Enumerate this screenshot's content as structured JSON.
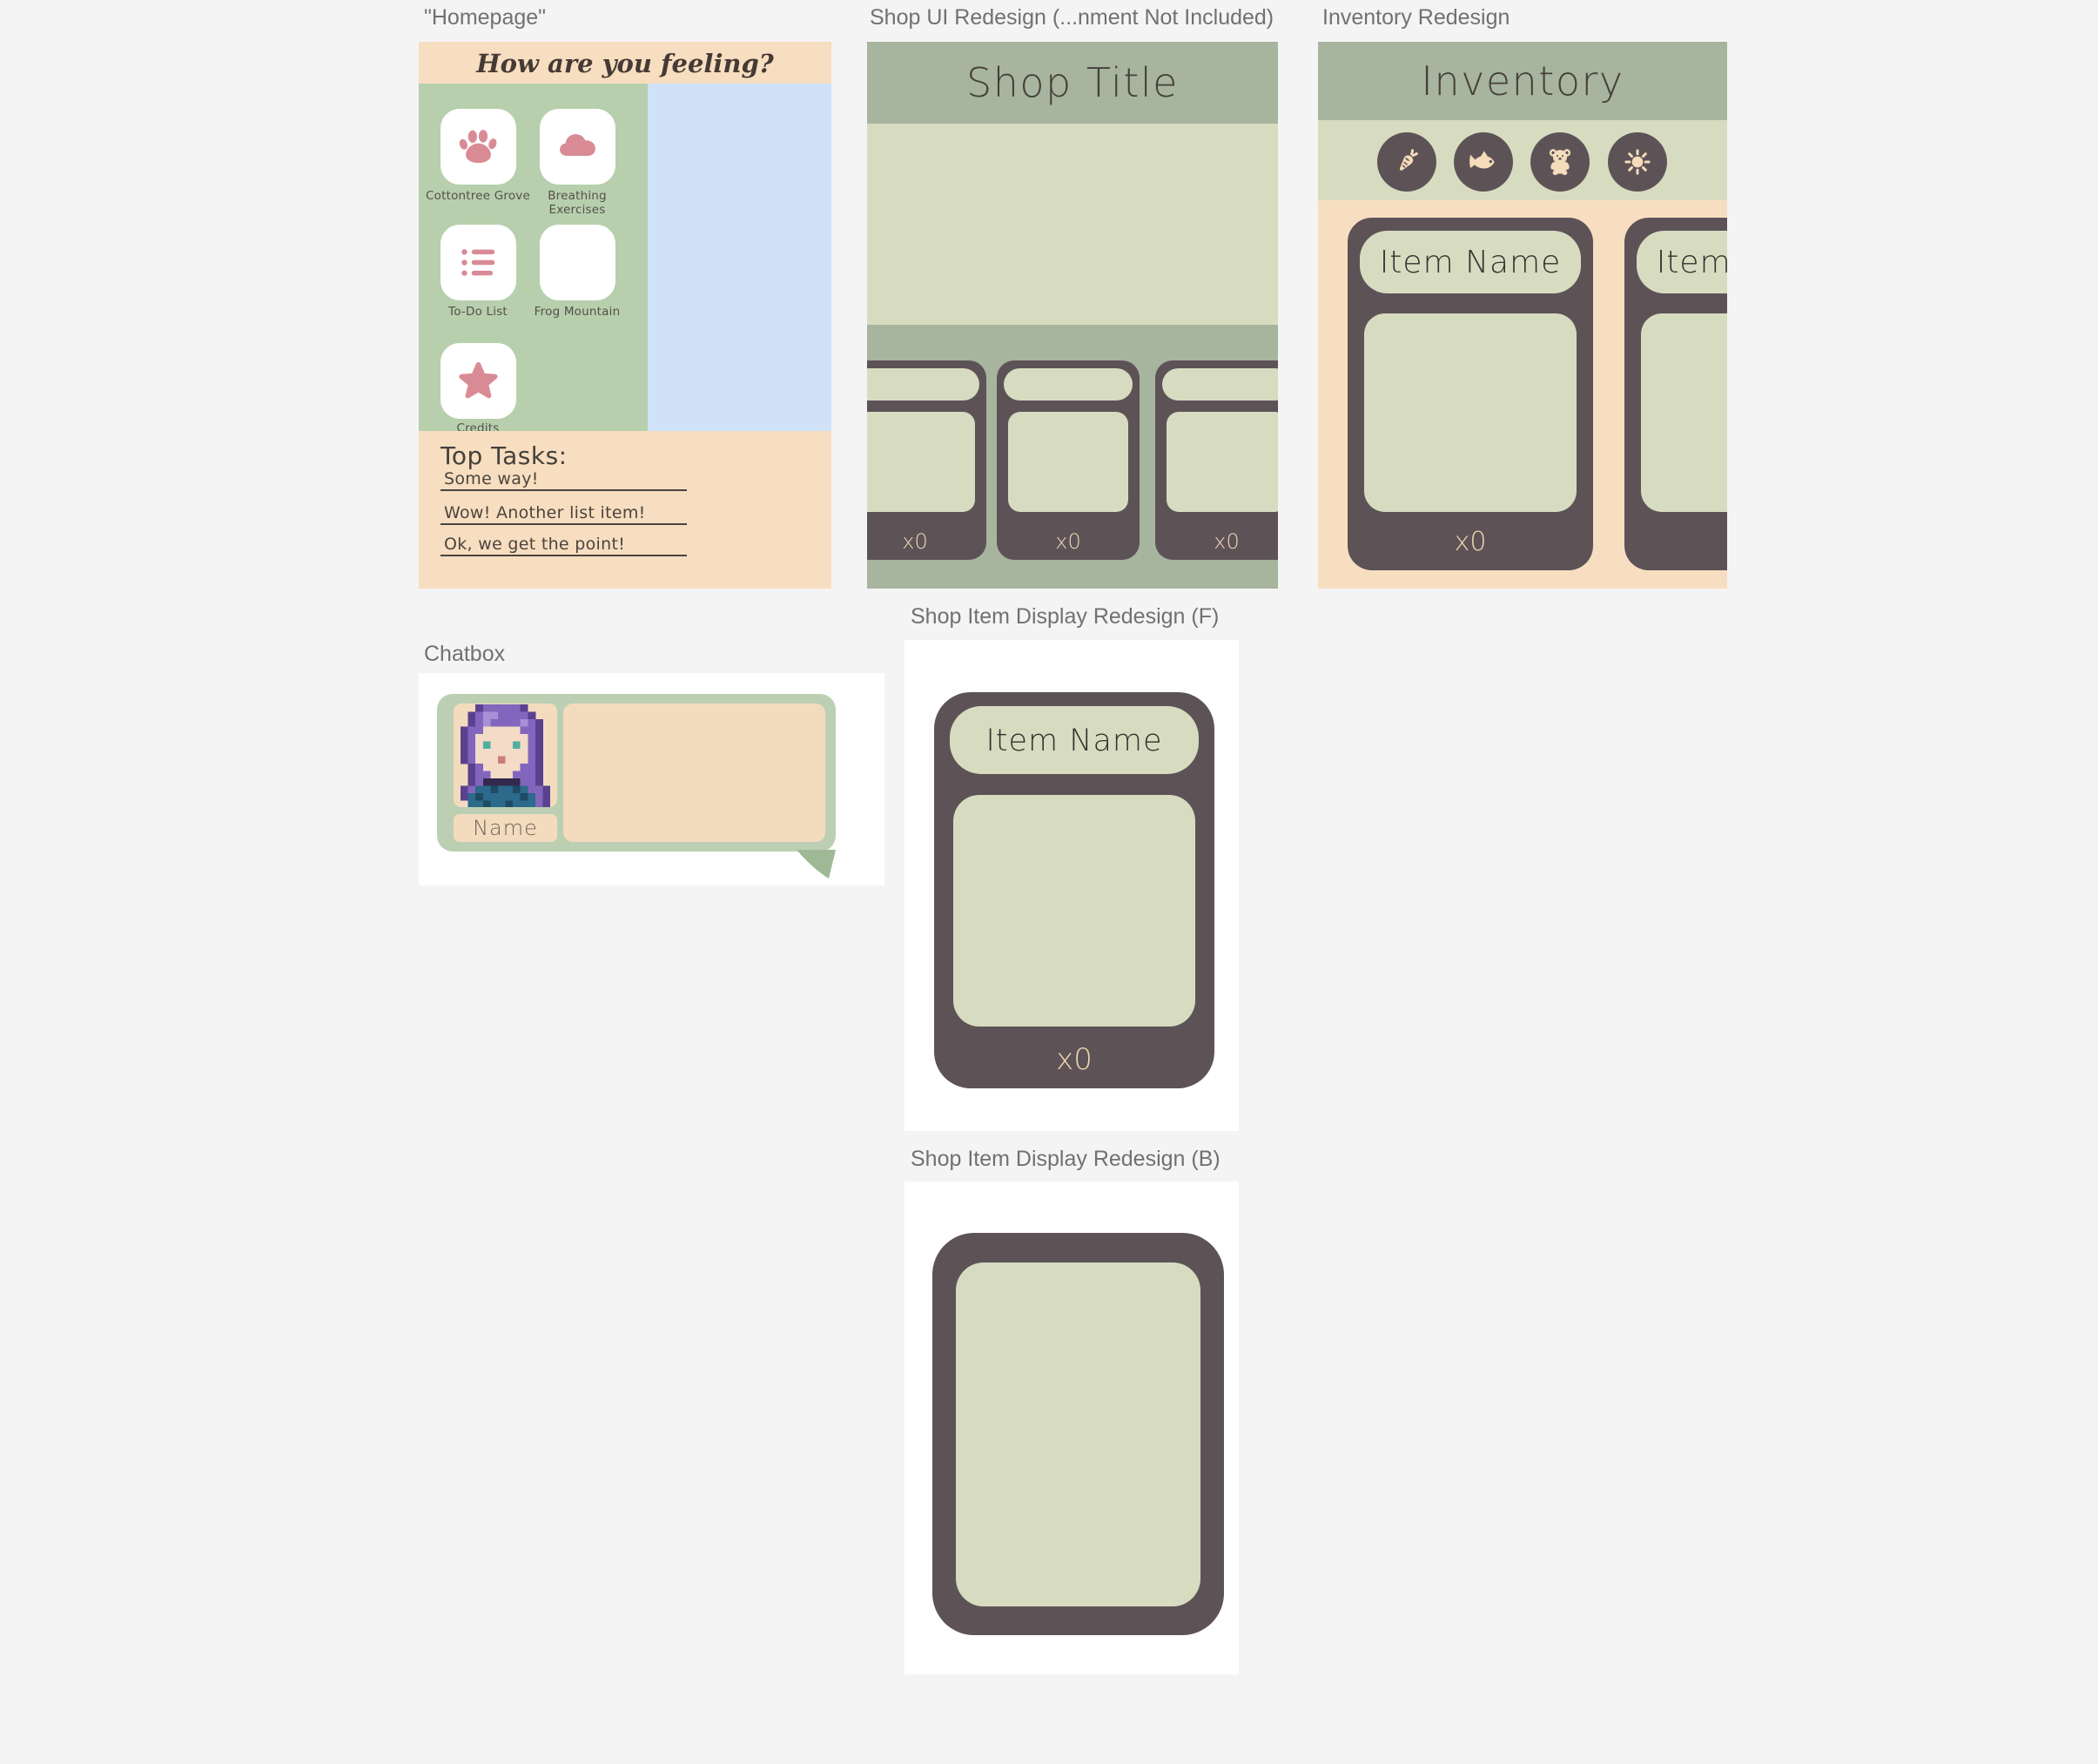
{
  "colors": {
    "canvas_bg": "#f4f4f5",
    "frame_label": "#717171",
    "peach": "#f7dec0",
    "homepage_green": "#b7cfad",
    "blue_panel": "#cfe2f8",
    "tile_white": "#ffffff",
    "icon_pink": "#d98b95",
    "sage": "#a7b49e",
    "pale_olive": "#d7dcc1",
    "card_dark": "#5d5357",
    "qty_peach": "#eed6b2",
    "text_dark": "#45403a",
    "chat_green": "#bccfb3",
    "chat_tail_green": "#9fb996",
    "chat_peach": "#f3dcbd",
    "underline": "#4a4440"
  },
  "homepage": {
    "label": "\"Homepage\"",
    "header_text": "How are you feeling?",
    "tiles": [
      {
        "label": "Cottontree Grove",
        "icon": "paw-icon"
      },
      {
        "label": "Breathing Exercises",
        "icon": "cloud-icon"
      },
      {
        "label": "To-Do List",
        "icon": "list-icon"
      },
      {
        "label": "Frog Mountain",
        "icon": "none"
      },
      {
        "label": "Credits",
        "icon": "star-icon"
      }
    ],
    "tasks": {
      "heading": "Top Tasks:",
      "items": [
        "Some way!",
        "Wow! Another list item!",
        "Ok, we get the point!"
      ]
    }
  },
  "shop": {
    "label": "Shop UI Redesign (...nment Not Included)",
    "title": "Shop Title",
    "cards": [
      {
        "qty": "x0"
      },
      {
        "qty": "x0"
      },
      {
        "qty": "x0"
      }
    ]
  },
  "inventory": {
    "label": "Inventory Redesign",
    "title": "Inventory",
    "categories": [
      {
        "icon": "carrot-icon"
      },
      {
        "icon": "fish-icon"
      },
      {
        "icon": "teddy-bear-icon"
      },
      {
        "icon": "sun-icon"
      }
    ],
    "cards": [
      {
        "name": "Item Name",
        "qty": "x0"
      },
      {
        "name": "Item Name",
        "qty": "x0"
      }
    ]
  },
  "chatbox": {
    "label": "Chatbox",
    "name_label": "Name",
    "avatar": {
      "palette": {
        "D": "#5a4190",
        "H": "#8266bd",
        "L": "#a88fd8",
        "S": "#f3dbc8",
        "E": "#4fae9f",
        "M": "#c97f74",
        "C": "#33294e",
        "T": "#2b6a8a",
        "K": "#1d4b63"
      },
      "rows": [
        "..DHHHHHD...",
        ".DHLLHHHHD..",
        ".DHLHHHHLHD.",
        "DHHSSSSSHHD.",
        "DHSSSSSSSHD.",
        "DHSESSSESHD.",
        "DHSSSSSSSHD.",
        "DHSSSMSSSHD.",
        ".DHSSSSSHHD.",
        ".DHHSSSHHHD.",
        ".DHCCCCCHHD.",
        "DHTTKTTKTHHD",
        "DTKTTTTTKTHD",
        "STTKTTKTTTHD"
      ]
    }
  },
  "item_front": {
    "label": "Shop Item Display Redesign (F)",
    "name": "Item Name",
    "qty": "x0"
  },
  "item_back": {
    "label": "Shop Item Display Redesign (B)"
  }
}
